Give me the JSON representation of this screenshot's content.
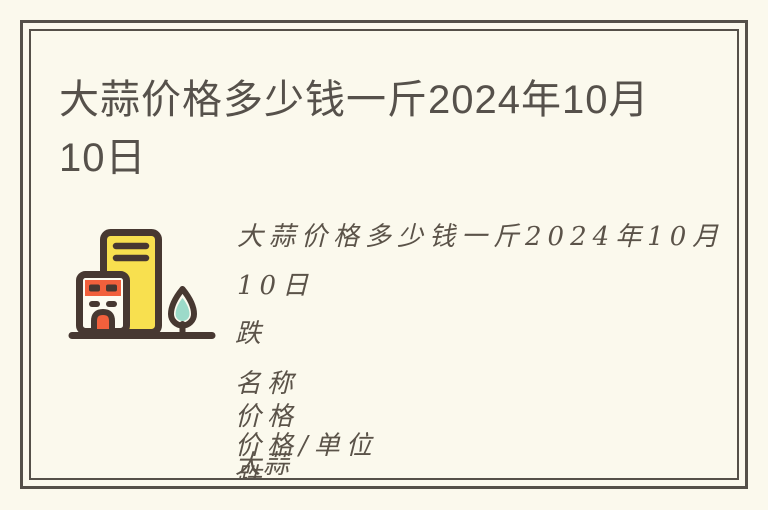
{
  "page": {
    "background_color": "#FBF9ED",
    "frame_border_color": "#555049"
  },
  "article": {
    "title_line1": "大蒜价格多少钱一斤2024年10月",
    "title_line2": "10日",
    "title_color": "#56514B"
  },
  "illustration": {
    "name": "buildings-with-tree",
    "colors": {
      "outline": "#473831",
      "tall_building_fill": "#F8E04F",
      "accent_orange": "#F2603C",
      "tree_teal": "#9CDAC9",
      "small_building_fill": "#FDFBF0"
    }
  },
  "body_lines": [
    "大蒜价格多少钱一斤2024年10月",
    "10日",
    "跌",
    "名称",
    "价格",
    "价格/单位",
    "大蒜",
    "跌"
  ],
  "body_text_color": "#5B5349"
}
